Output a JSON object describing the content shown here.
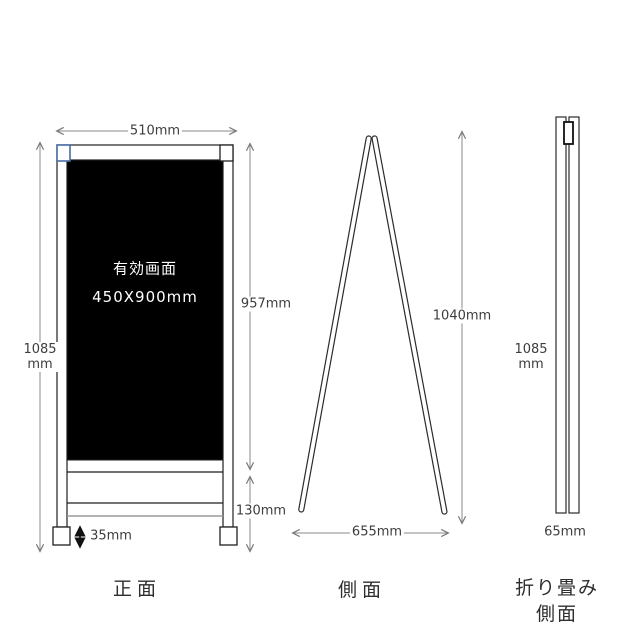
{
  "drawing": {
    "front": {
      "view_label": "正面",
      "board": {
        "line1": "有効画面",
        "line2": "450X900mm"
      },
      "dim_width": "510mm",
      "dim_height_line1": "1085",
      "dim_height_line2": "mm",
      "dim_board_height": "957mm",
      "dim_base_height": "130mm",
      "dim_foot_height": "35mm"
    },
    "side": {
      "view_label": "側面",
      "dim_height": "1040mm",
      "dim_depth": "655mm"
    },
    "folded": {
      "view_label_line1": "折り畳み",
      "view_label_line2": "側面",
      "dim_height_line1": "1085",
      "dim_height_line2": "mm",
      "dim_thickness": "65mm"
    }
  },
  "colors": {
    "line": "#1f1f1f",
    "dimension_line": "#7d7d7d",
    "board_fill": "#000000",
    "corner_blue": "#4a6da7",
    "rail_gray": "#9a9a9a",
    "text": "#3d3d3d"
  }
}
